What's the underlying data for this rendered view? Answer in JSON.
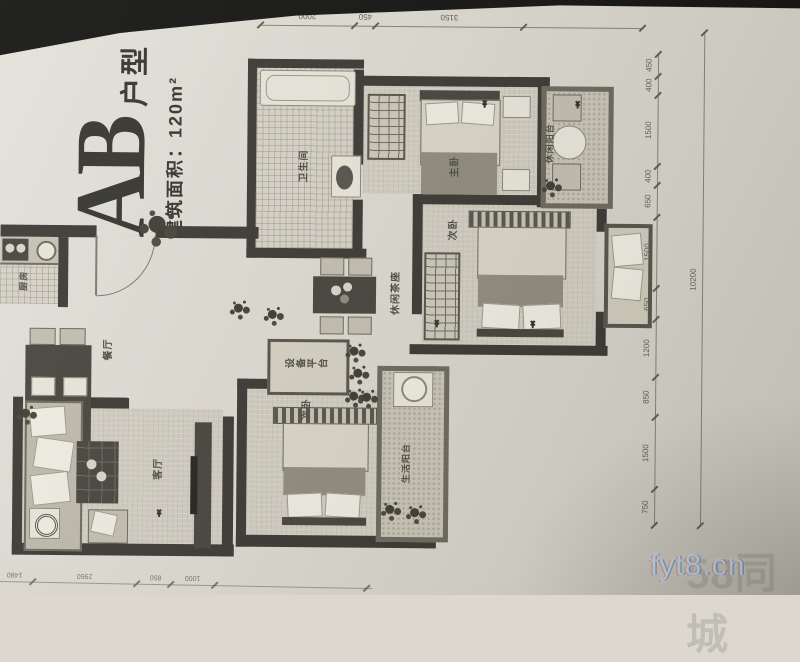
{
  "title": {
    "ab": "AB",
    "suffix": "户型",
    "area": "建筑面积：120m²"
  },
  "rooms": {
    "bathroom": {
      "label": "卫生间"
    },
    "master_bedroom": {
      "label": "主卧"
    },
    "balcony_top": {
      "label": "休闲阳台"
    },
    "bedroom2": {
      "label": "次卧"
    },
    "tea_area": {
      "label": "休闲茶座"
    },
    "equipment": {
      "label": "设备平台"
    },
    "bedroom3": {
      "label": "次卧"
    },
    "balcony_bottom": {
      "label": "生活阳台"
    },
    "dining": {
      "label": "餐厅"
    },
    "living": {
      "label": "客厅"
    },
    "kitchen": {
      "label": "厨房"
    }
  },
  "dimensions": {
    "right_chain": [
      "450",
      "400",
      "1500",
      "400",
      "650",
      "1500",
      "650",
      "1200",
      "850",
      "1500",
      "750"
    ],
    "overall": "10200",
    "top_chain": [
      "2000",
      "450",
      "3150"
    ],
    "bottom_chain": [
      "1480",
      "2950",
      "850",
      "1000"
    ]
  },
  "watermark": {
    "site": "fyt8.cn",
    "background": "58同城"
  }
}
